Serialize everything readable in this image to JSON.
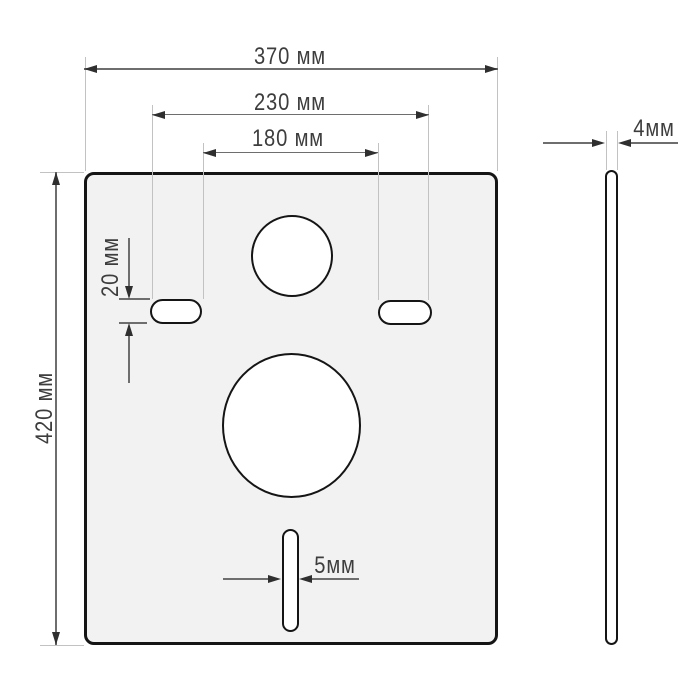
{
  "drawing": {
    "unit": "мм",
    "dimensions": {
      "plate_width": {
        "label": "370 мм",
        "value": 370,
        "unit": "мм"
      },
      "slots_outer_span": {
        "label": "230 мм",
        "value": 230,
        "unit": "мм"
      },
      "slots_inner_span": {
        "label": "180 мм",
        "value": 180,
        "unit": "мм"
      },
      "plate_height": {
        "label": "420 мм",
        "value": 420,
        "unit": "мм"
      },
      "mount_slot_height": {
        "label": "20 мм",
        "value": 20,
        "unit": "мм"
      },
      "bottom_slot_width": {
        "label": "5мм",
        "value": 5,
        "unit": "мм"
      },
      "plate_thickness": {
        "label": "4мм",
        "value": 4,
        "unit": "мм"
      }
    },
    "colors": {
      "background": "#ffffff",
      "plate_fill": "#f2f2f3",
      "outline": "#151515",
      "hole_fill": "#ffffff",
      "dimension_line": "#6e6e6e",
      "extension_line": "#c2c2c2",
      "arrowhead": "#2f2f2f",
      "text": "#3d3d3d"
    }
  }
}
